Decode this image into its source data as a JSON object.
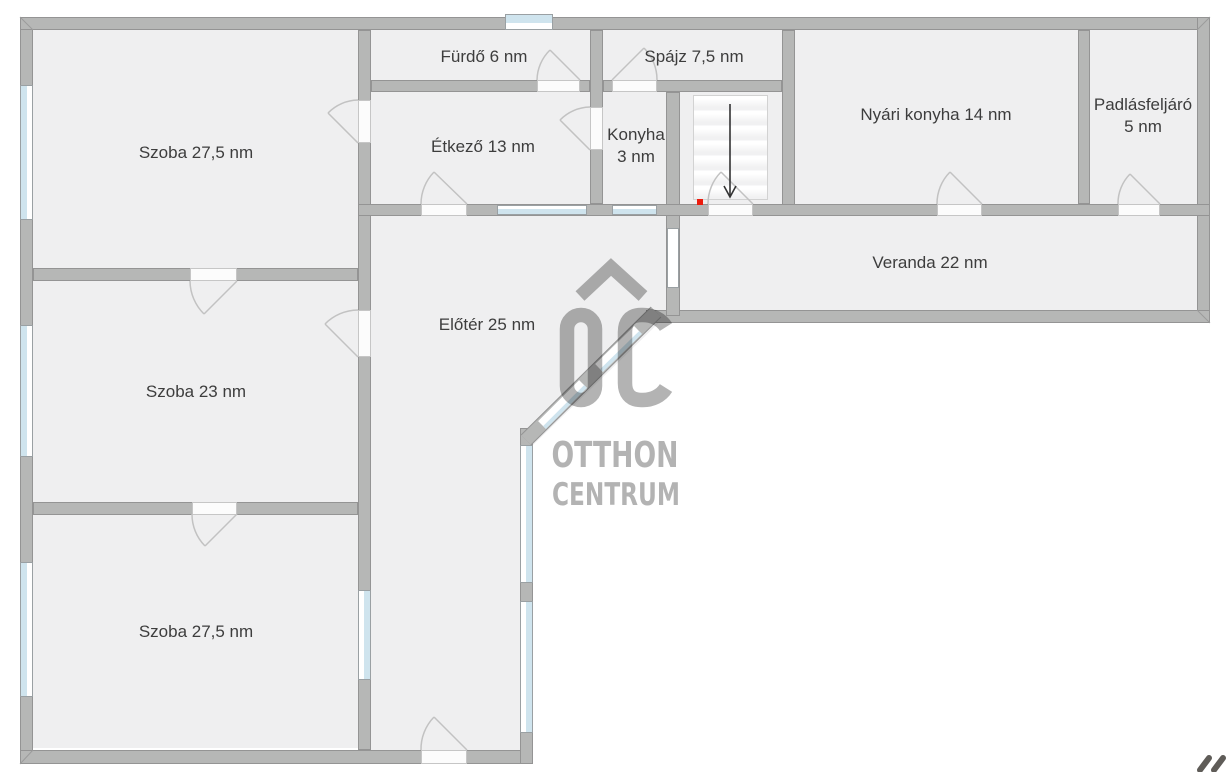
{
  "plan": {
    "title": "Otthon Centrum floor plan",
    "rooms": {
      "szoba_top": {
        "label": "Szoba 27,5 nm"
      },
      "furdo": {
        "label": "Fürdő 6 nm"
      },
      "spajz": {
        "label": "Spájz 7,5 nm"
      },
      "etkezo": {
        "label": "Étkező 13 nm"
      },
      "konyha": {
        "line1": "Konyha",
        "line2": "3 nm"
      },
      "nyari_konyha": {
        "label": "Nyári konyha 14 nm"
      },
      "padlasfeljaro": {
        "line1": "Padlásfeljáró",
        "line2": "5 nm"
      },
      "veranda": {
        "label": "Veranda 22 nm"
      },
      "eloter": {
        "label": "Előtér 25 nm"
      },
      "szoba_mid": {
        "label": "Szoba 23 nm"
      },
      "szoba_bottom": {
        "label": "Szoba 27,5 nm"
      }
    },
    "watermark": {
      "line1": "OTTHON",
      "line2": "CENTRUM"
    },
    "stairs": {
      "direction": "down"
    },
    "colors": {
      "wall": "#b6b7b6",
      "room_fill": "#efeff0",
      "window_glass": "#cfe4ee",
      "marker_red": "#ec1c0e",
      "watermark_gray": "#b3b3b3",
      "label_text": "#3d3d3d"
    }
  }
}
